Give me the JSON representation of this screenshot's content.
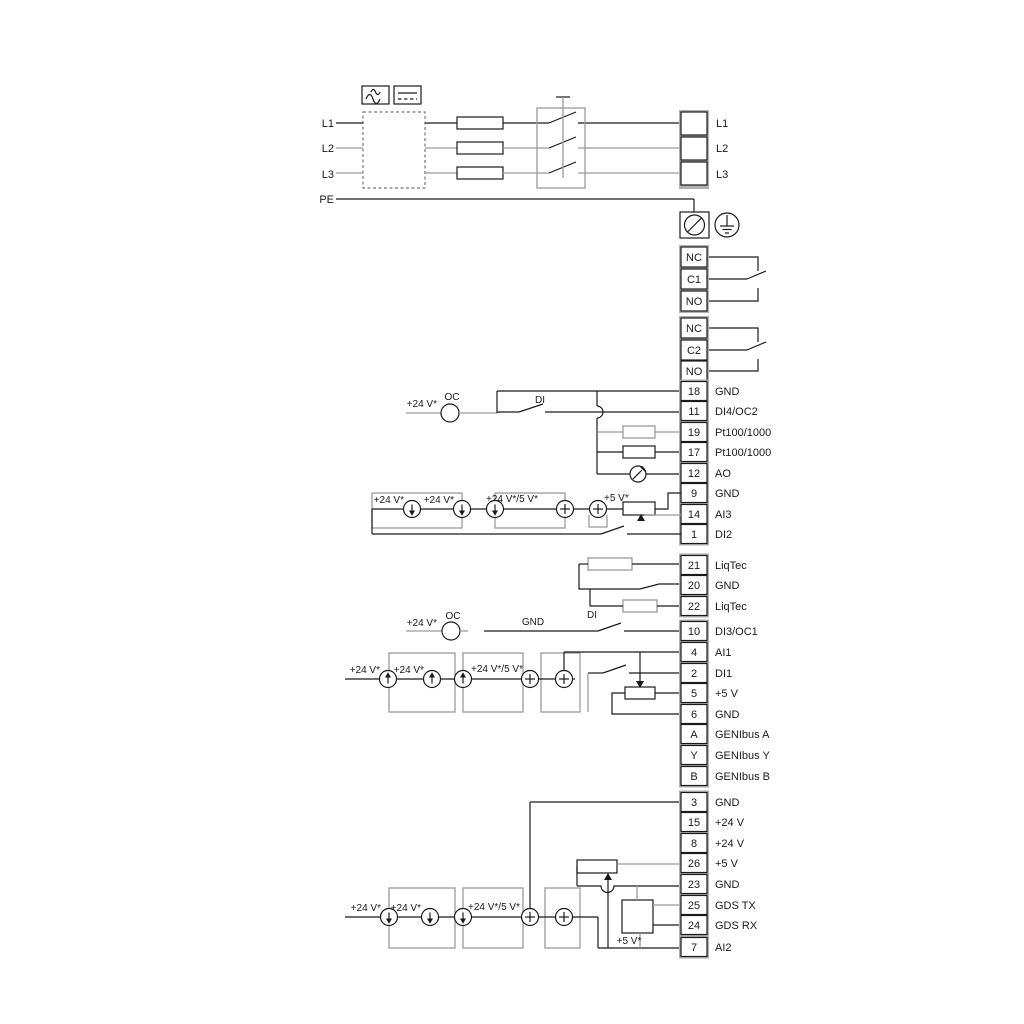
{
  "colors": {
    "line_dark": "#1a1a1a",
    "line_gray": "#9a9a9a",
    "terminal_block_fill": "#b0b0b0",
    "background": "#ffffff"
  },
  "symbols": {
    "ac_box": "sine-wave-icon",
    "dc_box": "dc-line-icon",
    "screw": "screw-terminal-icon",
    "earth": "earth-ground-icon",
    "source": "current-source-icon",
    "gauge": "analog-output-gauge-icon"
  },
  "labels": {
    "v24": "+24 V*",
    "v24_5": "+24 V*/5 V*",
    "v5": "+5 V*",
    "oc": "OC",
    "di": "DI",
    "gnd": "GND"
  },
  "power": {
    "inputs": [
      "L1",
      "L2",
      "L3",
      "PE"
    ],
    "outputs": [
      "L1",
      "L2",
      "L3"
    ]
  },
  "relay1": [
    "NC",
    "C1",
    "NO"
  ],
  "relay2": [
    "NC",
    "C2",
    "NO"
  ],
  "io1": [
    {
      "num": "18",
      "label": "GND"
    },
    {
      "num": "11",
      "label": "DI4/OC2"
    },
    {
      "num": "19",
      "label": "Pt100/1000"
    },
    {
      "num": "17",
      "label": "Pt100/1000"
    },
    {
      "num": "12",
      "label": "AO"
    },
    {
      "num": "9",
      "label": "GND"
    },
    {
      "num": "14",
      "label": "AI3"
    },
    {
      "num": "1",
      "label": "DI2"
    }
  ],
  "liqtec": [
    {
      "num": "21",
      "label": "LiqTec"
    },
    {
      "num": "20",
      "label": "GND"
    },
    {
      "num": "22",
      "label": "LiqTec"
    }
  ],
  "io2": [
    {
      "num": "10",
      "label": "DI3/OC1"
    },
    {
      "num": "4",
      "label": "AI1"
    },
    {
      "num": "2",
      "label": "DI1"
    },
    {
      "num": "5",
      "label": "+5 V"
    },
    {
      "num": "6",
      "label": "GND"
    },
    {
      "num": "A",
      "label": "GENIbus A"
    },
    {
      "num": "Y",
      "label": "GENIbus Y"
    },
    {
      "num": "B",
      "label": "GENIbus B"
    }
  ],
  "io3": [
    {
      "num": "3",
      "label": "GND"
    },
    {
      "num": "15",
      "label": "+24 V"
    },
    {
      "num": "8",
      "label": "+24 V"
    },
    {
      "num": "26",
      "label": "+5 V"
    },
    {
      "num": "23",
      "label": "GND"
    },
    {
      "num": "25",
      "label": "GDS TX"
    },
    {
      "num": "24",
      "label": "GDS RX"
    },
    {
      "num": "7",
      "label": "AI2"
    }
  ]
}
